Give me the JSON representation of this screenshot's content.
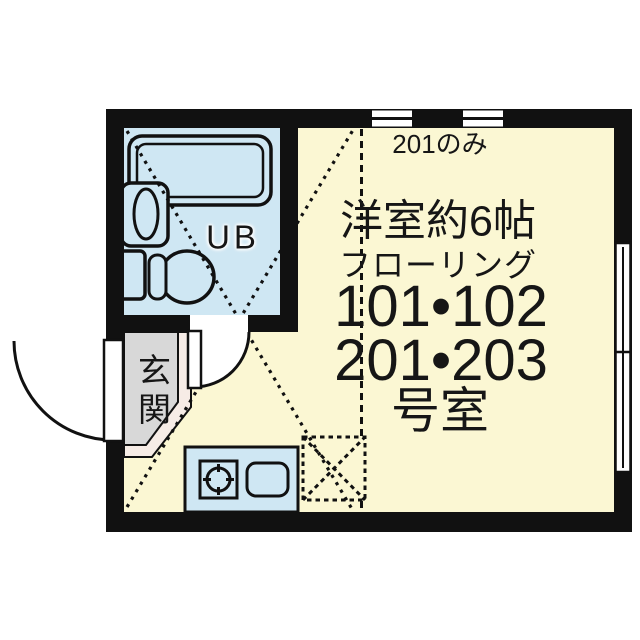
{
  "labels": {
    "window_note": "201のみ",
    "room_name": "洋室約6帖",
    "flooring": "フローリング",
    "rooms_line1": "101•102",
    "rooms_line2": "201•203",
    "rooms_suffix": "号室",
    "unit_bath": "UB",
    "entrance": "玄関"
  },
  "colors": {
    "bg": "#ffffff",
    "wall": "#111111",
    "floor": "#fbf7d3",
    "wet": "#cfe7f3",
    "genkan": "#d8d8d8",
    "step": "#f6ece6",
    "line": "#111111",
    "text": "#161616"
  },
  "fixtures": [
    "bathtub",
    "vanity-sink",
    "toilet",
    "kitchen-counter",
    "stove-burner",
    "kitchen-sink",
    "refrigerator-space",
    "entrance-door",
    "bath-door",
    "window-top-1",
    "window-top-2",
    "window-right",
    "loft-diagonal-lines"
  ]
}
